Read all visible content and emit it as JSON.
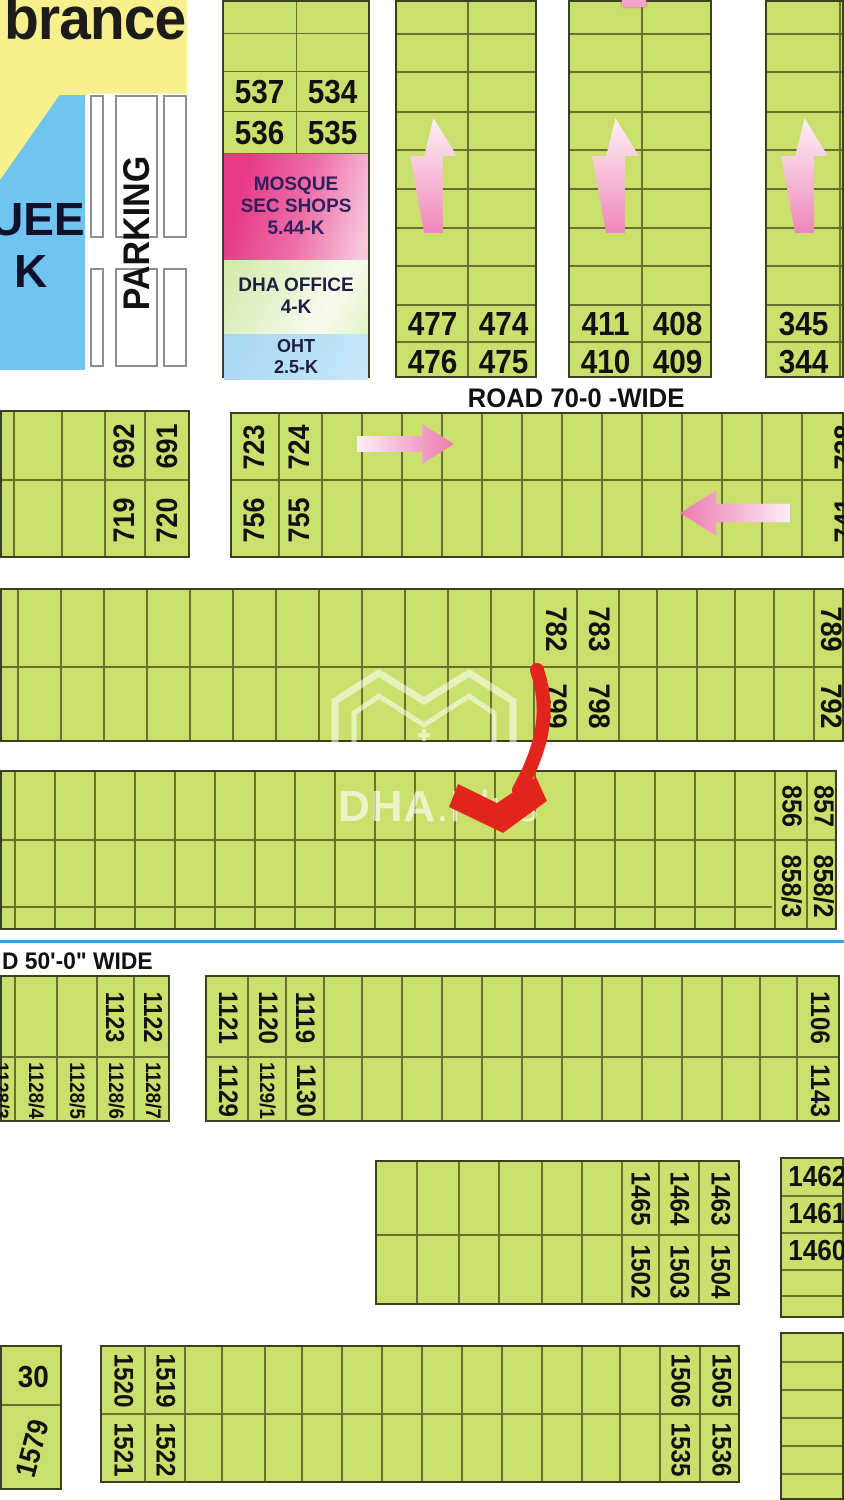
{
  "map": {
    "colors": {
      "plot_green": "#cbe06c",
      "grid_line": "#66722e",
      "block_border": "#3a411f",
      "park_yellow": "#f7f08c",
      "mosque_blue": "#6fc5ef",
      "facility_pink": "#e73a88",
      "oht_blue": "#a6d7f2",
      "pink_arrow": "#ee87b9",
      "red_marker": "#e2251c",
      "road_line_blue": "#3f9bd7"
    },
    "areas": {
      "remembrance": {
        "label": "brance"
      },
      "mosque_park": {
        "line1": "UEE",
        "line2": "K"
      },
      "parking": {
        "label": "PARKING"
      }
    },
    "legend": {
      "plot_rows": [
        [
          "537",
          "534"
        ],
        [
          "536",
          "535"
        ]
      ],
      "facilities": [
        {
          "id": "mosque",
          "lines": [
            "MOSQUE",
            "SEC SHOPS",
            "5.44-K"
          ]
        },
        {
          "id": "dha-office",
          "lines": [
            "DHA OFFICE",
            "4-K"
          ]
        },
        {
          "id": "oht",
          "lines": [
            "OHT",
            "2.5-K"
          ]
        }
      ]
    },
    "roads": {
      "road70": "ROAD 70-0 -WIDE",
      "road50": "D 50'-0\" WIDE"
    },
    "watermark": {
      "text_bold": "DHA",
      "text_light": ".Plus"
    },
    "pink_arrows": [
      {
        "dir": "up",
        "x": 410,
        "y": 118,
        "w": 47,
        "h": 115
      },
      {
        "dir": "up",
        "x": 592,
        "y": 118,
        "w": 47,
        "h": 115
      },
      {
        "dir": "up",
        "x": 781,
        "y": 118,
        "w": 47,
        "h": 115
      },
      {
        "dir": "right",
        "x": 357,
        "y": 424,
        "w": 97,
        "h": 40
      },
      {
        "dir": "left",
        "x": 680,
        "y": 490,
        "w": 110,
        "h": 46
      },
      {
        "dir": "stub",
        "x": 622,
        "y": 0,
        "w": 24,
        "h": 7
      }
    ],
    "blocks": [
      {
        "name": "top-block-1",
        "x": 395,
        "y": 0,
        "w": 142,
        "h": 378,
        "fs": 33,
        "cols": [
          0,
          71,
          142
        ],
        "rows": [
          0,
          32,
          70,
          110,
          148,
          187,
          226,
          264,
          303,
          340,
          378
        ],
        "hlabels": [
          {
            "c": 0,
            "r": 8,
            "t": "477"
          },
          {
            "c": 1,
            "r": 8,
            "t": "474"
          },
          {
            "c": 0,
            "r": 9,
            "t": "476"
          },
          {
            "c": 1,
            "r": 9,
            "t": "475"
          }
        ]
      },
      {
        "name": "top-block-2",
        "x": 568,
        "y": 0,
        "w": 144,
        "h": 378,
        "fs": 33,
        "cols": [
          0,
          72,
          144
        ],
        "rows": [
          0,
          32,
          70,
          110,
          148,
          187,
          226,
          264,
          303,
          340,
          378
        ],
        "hlabels": [
          {
            "c": 0,
            "r": 8,
            "t": "411"
          },
          {
            "c": 1,
            "r": 8,
            "t": "408"
          },
          {
            "c": 0,
            "r": 9,
            "t": "410"
          },
          {
            "c": 1,
            "r": 9,
            "t": "409"
          }
        ]
      },
      {
        "name": "top-block-3",
        "x": 765,
        "y": 0,
        "w": 79,
        "h": 378,
        "fs": 33,
        "cols": [
          0,
          73,
          79
        ],
        "rows": [
          0,
          32,
          70,
          110,
          148,
          187,
          226,
          264,
          303,
          340,
          378
        ],
        "hlabels": [
          {
            "c": 0,
            "r": 8,
            "t": "345"
          },
          {
            "c": 0,
            "r": 9,
            "t": "344"
          }
        ]
      },
      {
        "name": "band-a1",
        "x": 0,
        "y": 410,
        "w": 190,
        "h": 148,
        "fs": 30,
        "rot": -90,
        "cols": [
          0,
          12,
          60,
          103,
          143,
          190
        ],
        "rows": [
          0,
          68,
          148
        ],
        "vlabels": [
          {
            "c": 3,
            "r": 0,
            "t": "692"
          },
          {
            "c": 3,
            "r": 1,
            "t": "719"
          },
          {
            "c": 4,
            "r": 0,
            "t": "691"
          },
          {
            "c": 4,
            "r": 1,
            "t": "720"
          }
        ]
      },
      {
        "name": "band-a2",
        "x": 230,
        "y": 412,
        "w": 614,
        "h": 146,
        "fs": 30,
        "rot": -90,
        "cols": [
          0,
          47,
          90,
          130,
          170,
          210,
          250,
          290,
          330,
          370,
          410,
          450,
          490,
          530,
          570,
          614
        ],
        "rows": [
          0,
          66,
          146
        ],
        "vlabels": [
          {
            "c": 0,
            "r": 0,
            "t": "723"
          },
          {
            "c": 0,
            "r": 1,
            "t": "756"
          },
          {
            "c": 1,
            "r": 0,
            "t": "724"
          },
          {
            "c": 1,
            "r": 1,
            "t": "755"
          },
          {
            "c": 14,
            "r": 0,
            "t": "738",
            "dx": 22
          },
          {
            "c": 14,
            "r": 1,
            "t": "741",
            "dx": 22
          }
        ]
      },
      {
        "name": "band-b",
        "x": 0,
        "y": 588,
        "w": 844,
        "h": 154,
        "fs": 30,
        "rot": 90,
        "cols": [
          0,
          16,
          59,
          102,
          145,
          188,
          231,
          274,
          317,
          360,
          403,
          446,
          489,
          532,
          575,
          617,
          655,
          695,
          733,
          772,
          812,
          844
        ],
        "rows": [
          0,
          77,
          154
        ],
        "vlabels": [
          {
            "c": 13,
            "r": 0,
            "t": "782"
          },
          {
            "c": 13,
            "r": 1,
            "t": "799"
          },
          {
            "c": 14,
            "r": 0,
            "t": "783"
          },
          {
            "c": 14,
            "r": 1,
            "t": "798"
          },
          {
            "c": 20,
            "r": 0,
            "t": "789"
          },
          {
            "c": 20,
            "r": 1,
            "t": "792"
          }
        ]
      },
      {
        "name": "band-c",
        "x": 0,
        "y": 770,
        "w": 837,
        "h": 160,
        "fs": 28,
        "rot": 90,
        "cols": [
          0,
          13,
          53,
          93,
          133,
          173,
          213,
          253,
          293,
          333,
          373,
          413,
          453,
          493,
          533,
          573,
          613,
          653,
          693,
          733,
          773,
          805,
          837
        ],
        "rows": [
          0,
          68,
          160
        ],
        "segs": [
          {
            "y": 135,
            "x1": 0,
            "x2": 770
          }
        ],
        "vlabels": [
          {
            "c": 20,
            "r": 0,
            "t": "856"
          },
          {
            "c": 20,
            "r": 1,
            "t": "858/3"
          },
          {
            "c": 21,
            "r": 0,
            "t": "857"
          },
          {
            "c": 21,
            "r": 1,
            "t": "858/2"
          }
        ]
      },
      {
        "name": "band-d1",
        "x": 0,
        "y": 975,
        "w": 170,
        "h": 147,
        "fs": 26,
        "rot": 90,
        "cols": [
          0,
          13,
          55,
          95,
          132,
          170
        ],
        "rows": [
          0,
          80,
          147
        ],
        "vlabels": [
          {
            "c": 3,
            "r": 0,
            "t": "1123"
          },
          {
            "c": 4,
            "r": 0,
            "t": "1122"
          },
          {
            "c": 0,
            "r": 1,
            "t": "1128/3",
            "fs": 21,
            "dx": -8
          },
          {
            "c": 1,
            "r": 1,
            "t": "1128/4",
            "fs": 21
          },
          {
            "c": 2,
            "r": 1,
            "t": "1128/5",
            "fs": 21
          },
          {
            "c": 3,
            "r": 1,
            "t": "1128/6",
            "fs": 21
          },
          {
            "c": 4,
            "r": 1,
            "t": "1128/7",
            "fs": 21
          }
        ]
      },
      {
        "name": "band-d2",
        "x": 205,
        "y": 975,
        "w": 635,
        "h": 147,
        "fs": 27,
        "rot": 90,
        "cols": [
          0,
          41,
          79,
          117,
          155,
          195,
          235,
          275,
          315,
          355,
          395,
          435,
          475,
          515,
          553,
          590,
          635
        ],
        "rows": [
          0,
          80,
          147
        ],
        "vlabels": [
          {
            "c": 0,
            "r": 0,
            "t": "1121"
          },
          {
            "c": 1,
            "r": 0,
            "t": "1120"
          },
          {
            "c": 2,
            "r": 0,
            "t": "1119"
          },
          {
            "c": 15,
            "r": 0,
            "t": "1106"
          },
          {
            "c": 0,
            "r": 1,
            "t": "1129"
          },
          {
            "c": 1,
            "r": 1,
            "t": "1129/1",
            "fs": 21
          },
          {
            "c": 2,
            "r": 1,
            "t": "1130"
          },
          {
            "c": 15,
            "r": 1,
            "t": "1143"
          }
        ]
      },
      {
        "name": "band-e1",
        "x": 375,
        "y": 1160,
        "w": 365,
        "h": 145,
        "fs": 27,
        "rot": 90,
        "cols": [
          0,
          40,
          82,
          122,
          165,
          205,
          245,
          282,
          322,
          365
        ],
        "rows": [
          0,
          73,
          145
        ],
        "vlabels": [
          {
            "c": 6,
            "r": 0,
            "t": "1465"
          },
          {
            "c": 7,
            "r": 0,
            "t": "1464"
          },
          {
            "c": 8,
            "r": 0,
            "t": "1463"
          },
          {
            "c": 6,
            "r": 1,
            "t": "1502"
          },
          {
            "c": 7,
            "r": 1,
            "t": "1503"
          },
          {
            "c": 8,
            "r": 1,
            "t": "1504"
          }
        ]
      },
      {
        "name": "band-e2",
        "x": 780,
        "y": 1157,
        "w": 64,
        "h": 161,
        "fs": 29,
        "cols": [
          0,
          64
        ],
        "rows": [
          0,
          37,
          74,
          111,
          137,
          161
        ],
        "hlabels": [
          {
            "c": 0,
            "r": 0,
            "t": "1462",
            "align": "left"
          },
          {
            "c": 0,
            "r": 1,
            "t": "1461",
            "align": "left"
          },
          {
            "c": 0,
            "r": 2,
            "t": "1460",
            "align": "left"
          }
        ]
      },
      {
        "name": "band-f0",
        "x": 0,
        "y": 1345,
        "w": 62,
        "h": 145,
        "fs": 31,
        "cols": [
          0,
          62
        ],
        "rows": [
          0,
          58,
          145
        ],
        "hlabels": [
          {
            "c": 0,
            "r": 0,
            "t": "30"
          }
        ],
        "vlabels": [
          {
            "c": 0,
            "r": 1,
            "t": "1579",
            "rot": -75,
            "fs": 29
          }
        ]
      },
      {
        "name": "band-f2",
        "x": 100,
        "y": 1345,
        "w": 640,
        "h": 138,
        "fs": 27,
        "rot": 90,
        "cols": [
          0,
          43,
          83,
          120,
          163,
          200,
          240,
          280,
          320,
          360,
          400,
          440,
          480,
          518,
          558,
          598,
          640
        ],
        "rows": [
          0,
          67,
          138
        ],
        "vlabels": [
          {
            "c": 0,
            "r": 0,
            "t": "1520"
          },
          {
            "c": 1,
            "r": 0,
            "t": "1519"
          },
          {
            "c": 14,
            "r": 0,
            "t": "1506"
          },
          {
            "c": 15,
            "r": 0,
            "t": "1505"
          },
          {
            "c": 0,
            "r": 1,
            "t": "1521"
          },
          {
            "c": 1,
            "r": 1,
            "t": "1522"
          },
          {
            "c": 14,
            "r": 1,
            "t": "1535"
          },
          {
            "c": 15,
            "r": 1,
            "t": "1536"
          }
        ]
      },
      {
        "name": "band-f3",
        "x": 780,
        "y": 1332,
        "w": 64,
        "h": 168,
        "cols": [
          0,
          64
        ],
        "rows": [
          0,
          28,
          56,
          84,
          112,
          140,
          168
        ]
      }
    ]
  }
}
